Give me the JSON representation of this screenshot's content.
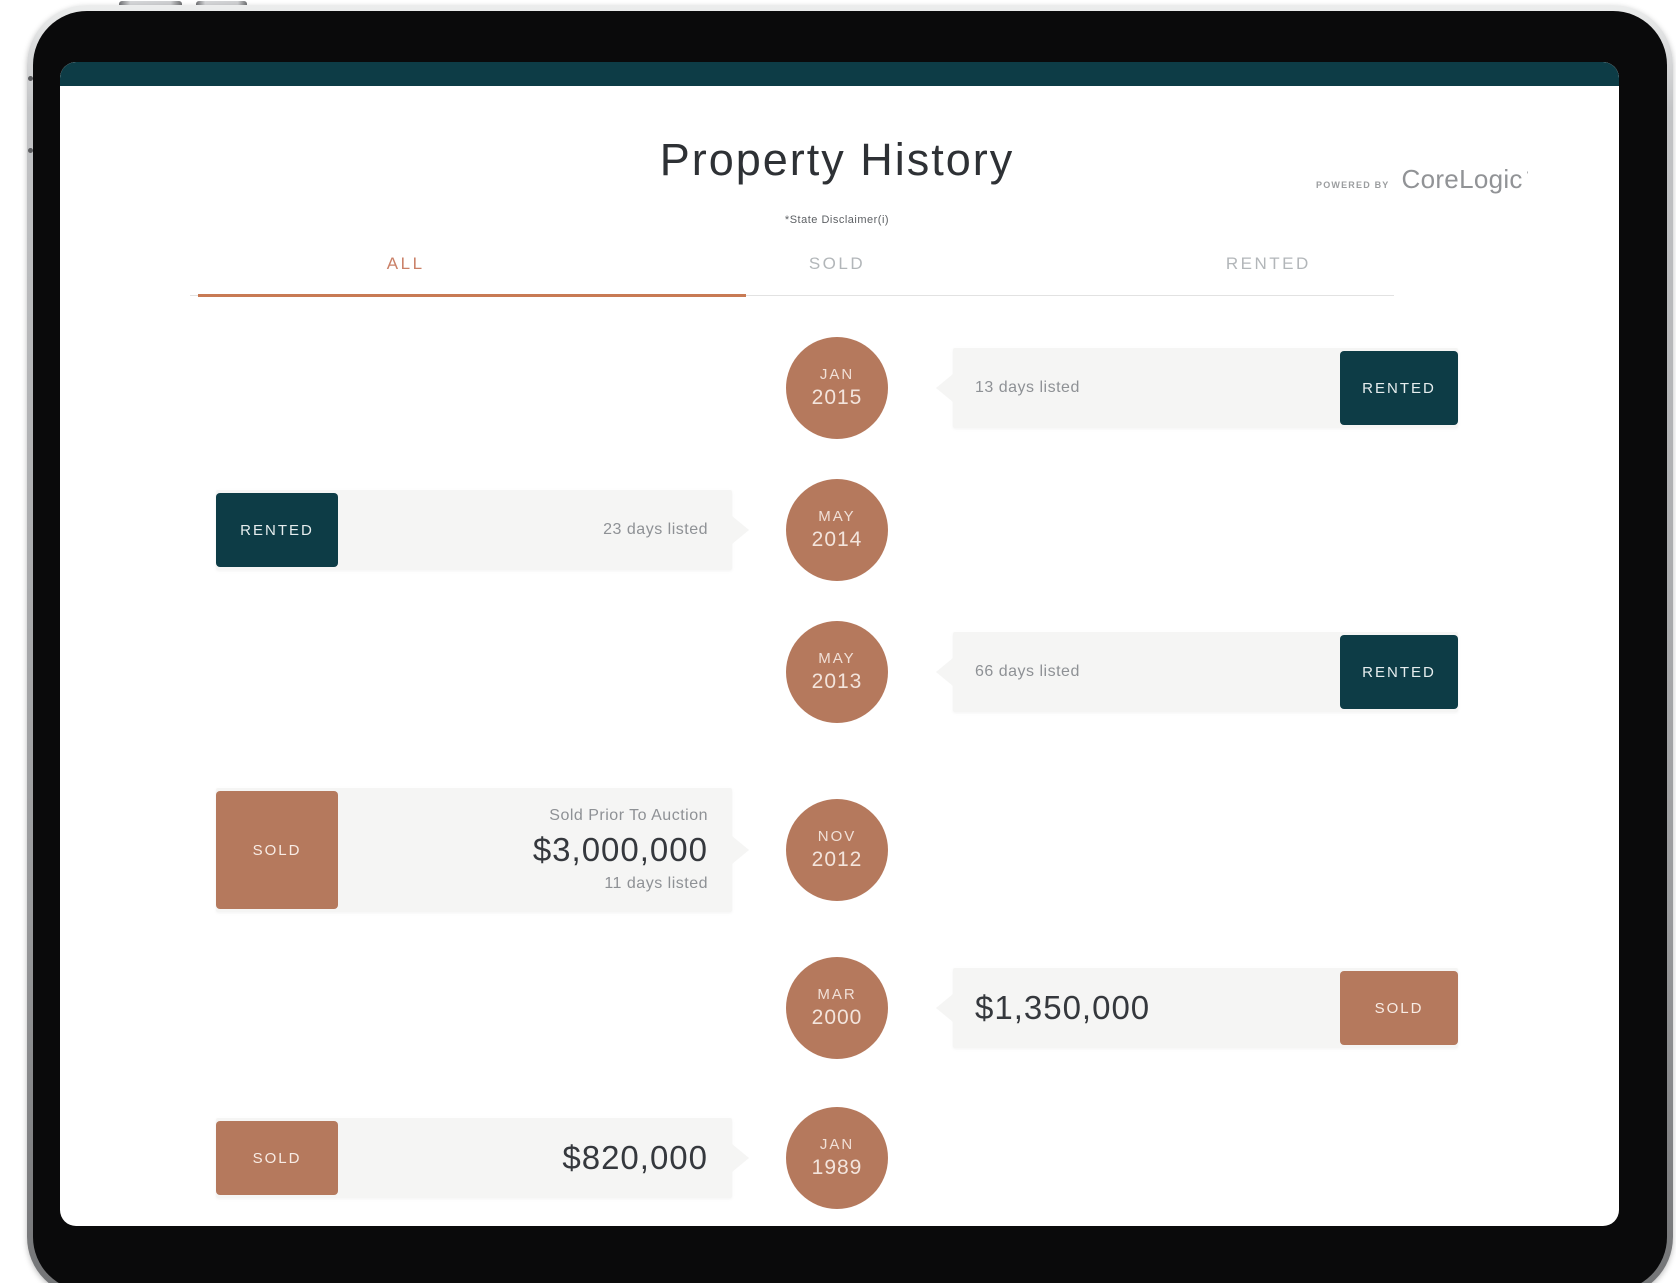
{
  "colors": {
    "accent": "#c87a54",
    "terracotta": "#b5795d",
    "teal": "#0d3c46",
    "card-bg": "#f5f5f4",
    "text-dark": "#35383d",
    "text-gray": "#8e9195",
    "tab-inactive": "#b2b6b9",
    "tab-active": "#ca8067"
  },
  "header": {
    "title": "Property History",
    "disclaimer": "*State Disclaimer(i)",
    "powered_by": "POWERED BY",
    "brand": "CoreLogic",
    "brand_mark": "'"
  },
  "tabs": [
    {
      "label": "ALL",
      "active": true
    },
    {
      "label": "SOLD",
      "active": false
    },
    {
      "label": "RENTED",
      "active": false
    }
  ],
  "timeline": [
    {
      "month": "JAN",
      "year": "2015",
      "side": "right",
      "status": "RENTED",
      "lines": [
        {
          "style": "small",
          "text": "13 days listed"
        }
      ]
    },
    {
      "month": "MAY",
      "year": "2014",
      "side": "left",
      "status": "RENTED",
      "lines": [
        {
          "style": "small",
          "text": "23 days listed"
        }
      ]
    },
    {
      "month": "MAY",
      "year": "2013",
      "side": "right",
      "status": "RENTED",
      "lines": [
        {
          "style": "small",
          "text": "66 days listed"
        }
      ]
    },
    {
      "month": "NOV",
      "year": "2012",
      "side": "left",
      "status": "SOLD",
      "lines": [
        {
          "style": "small",
          "text": "Sold Prior To Auction"
        },
        {
          "style": "price",
          "text": "$3,000,000"
        },
        {
          "style": "small",
          "text": "11 days listed"
        }
      ]
    },
    {
      "month": "MAR",
      "year": "2000",
      "side": "right",
      "status": "SOLD",
      "lines": [
        {
          "style": "price",
          "text": "$1,350,000"
        }
      ]
    },
    {
      "month": "JAN",
      "year": "1989",
      "side": "left",
      "status": "SOLD",
      "lines": [
        {
          "style": "price",
          "text": "$820,000"
        }
      ]
    }
  ]
}
